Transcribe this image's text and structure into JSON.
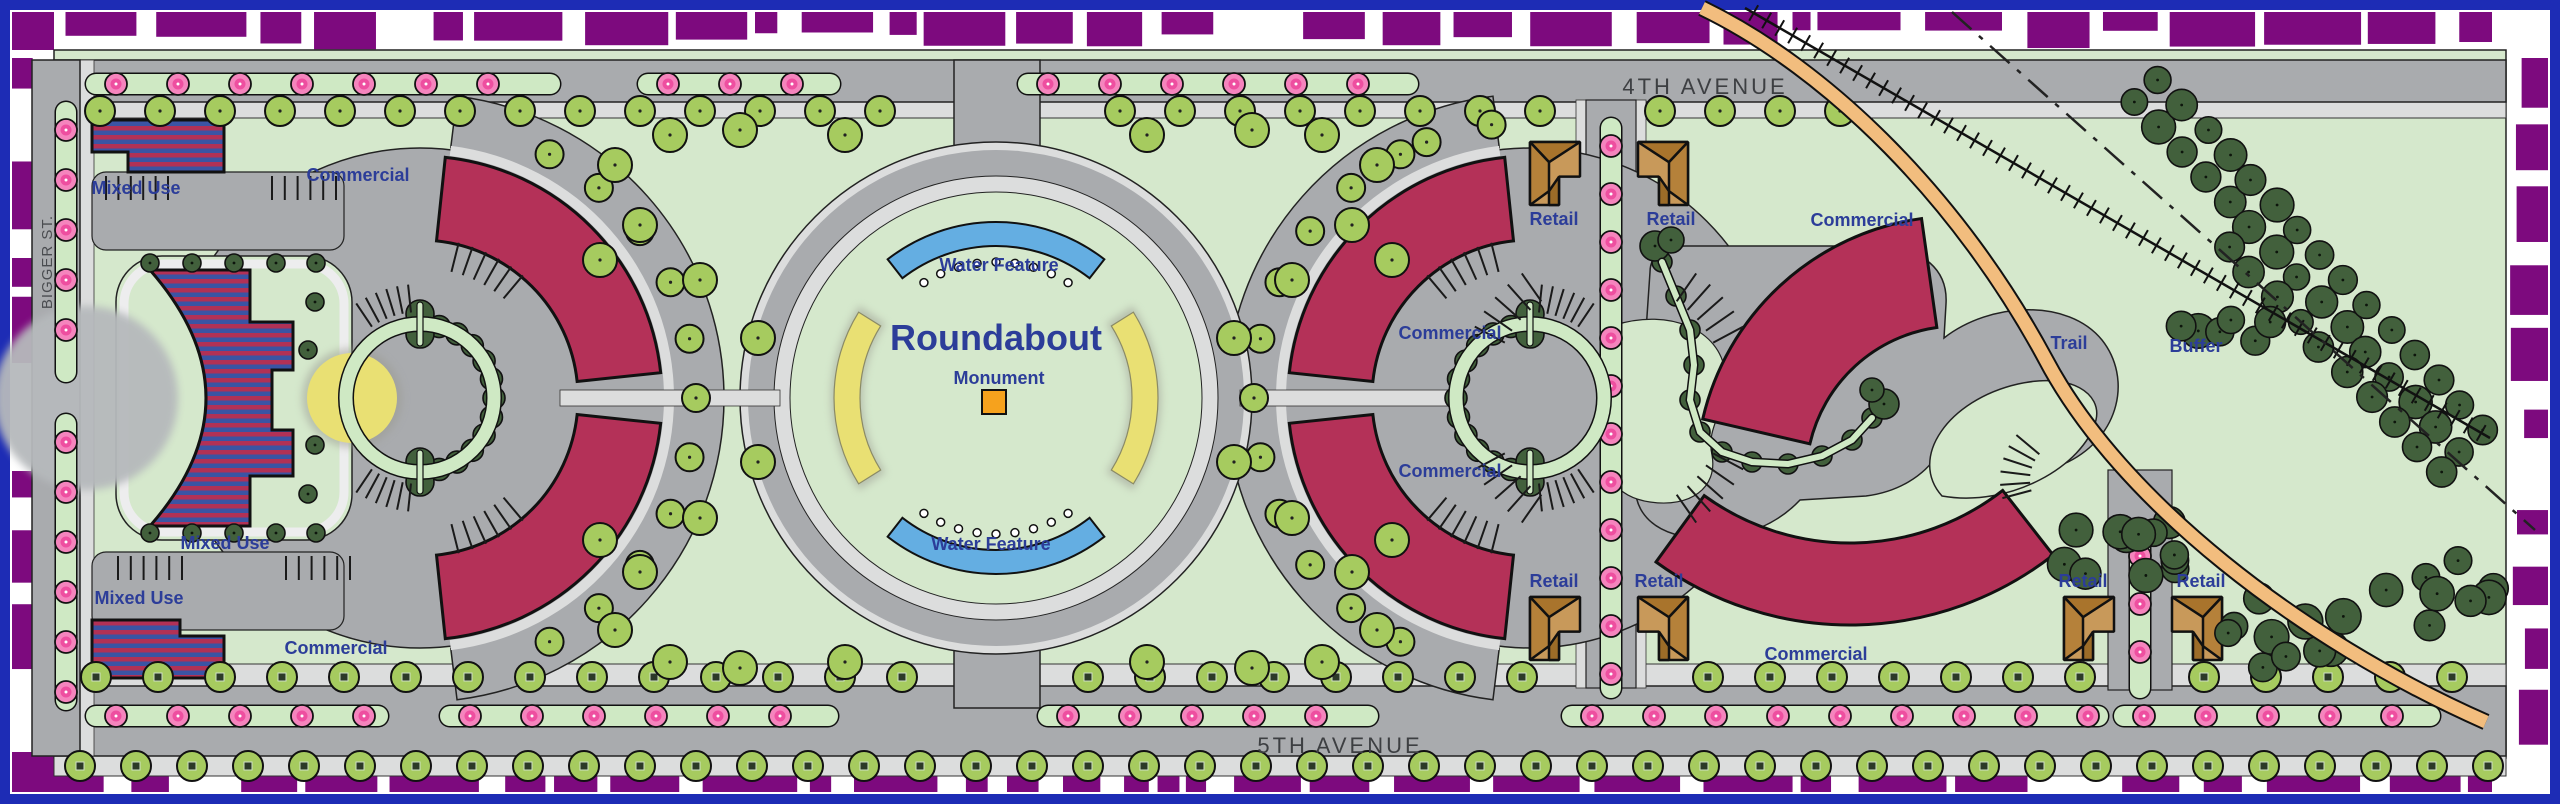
{
  "title": "Roundabout District Site Plan",
  "streets": {
    "north_avenue": "4TH AVENUE",
    "south_avenue": "5TH AVENUE",
    "west_street": "BIGGER ST."
  },
  "features": {
    "roundabout": "Roundabout",
    "monument": "Monument",
    "water_feature": "Water Feature",
    "trail": "Trail",
    "buffer": "Buffer"
  },
  "zones": {
    "mixed_use": "Mixed Use",
    "commercial": "Commercial",
    "retail": "Retail"
  },
  "label_counts": {
    "mixed_use": 3,
    "commercial": 6,
    "retail": 6,
    "water_feature": 2
  },
  "palette": {
    "frame": "#1d2cb5",
    "purple": "#7d0a7e",
    "green": "#d5e8cc",
    "road": "#a9abae",
    "walk": "#dcdddd",
    "brick": "#b43158",
    "sblue": "#3b54a4",
    "tan": "#c8995a",
    "brown": "#a9742c",
    "tree": "#a6cb5f",
    "dtree": "#42603c",
    "pink": "#f584bd",
    "dpink": "#ee4fa0",
    "water": "#64aee2",
    "yellow": "#e9e073",
    "orange": "#f6a21d",
    "lblue": "#2c3d99",
    "stext": "#3d3f42",
    "trailc": "#f2bd7e",
    "gravel": "#b6b9bc"
  }
}
